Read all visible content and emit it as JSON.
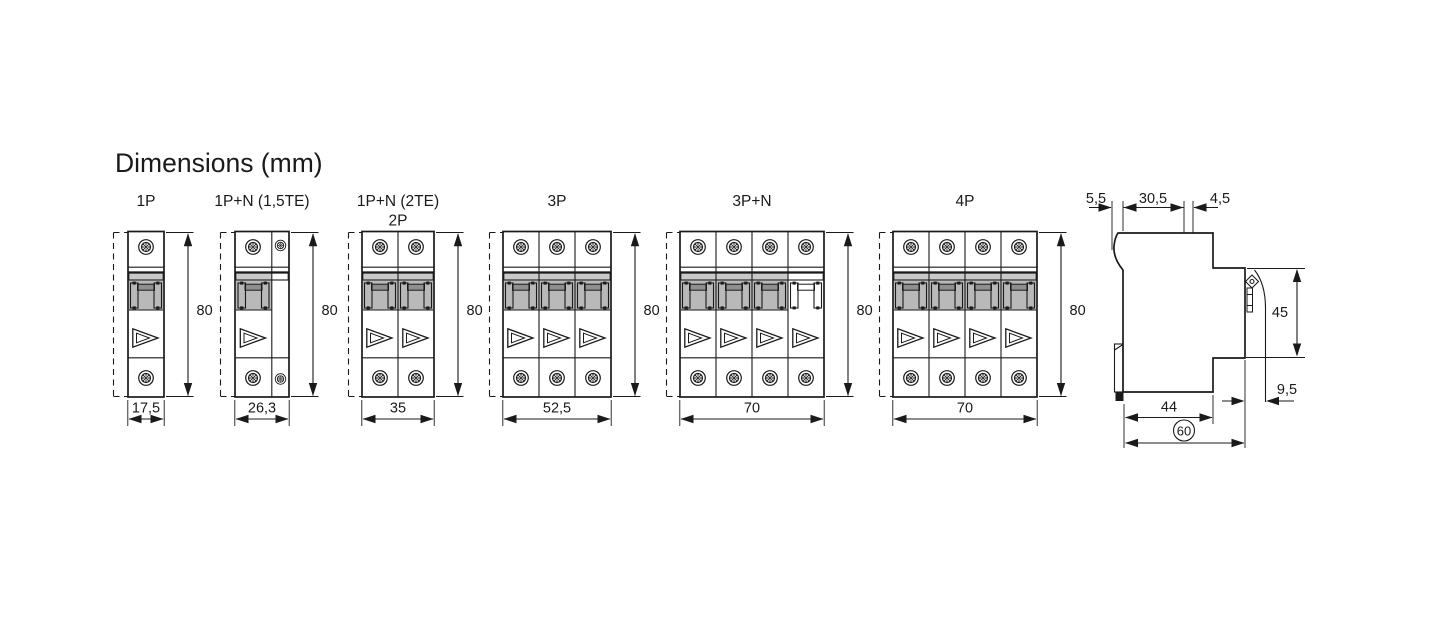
{
  "title": "Dimensions (mm)",
  "breakers": [
    {
      "label": "1P",
      "height_mm": "80",
      "width_mm": "17,5"
    },
    {
      "label": "1P+N (1,5TE)",
      "height_mm": "80",
      "width_mm": "26,3"
    },
    {
      "label": "1P+N (2TE)",
      "label_line2": "2P",
      "height_mm": "80",
      "width_mm": "35"
    },
    {
      "label": "3P",
      "height_mm": "80",
      "width_mm": "52,5"
    },
    {
      "label": "3P+N",
      "height_mm": "80",
      "width_mm": "70"
    },
    {
      "label": "4P",
      "height_mm": "80",
      "width_mm": "70"
    }
  ],
  "side_view": {
    "rear_hook_depth": "5,5",
    "rear_to_handle": "30,5",
    "handle_width": "4,5",
    "front_height": "45",
    "terminal_depth": "9,5",
    "base_depth": "44",
    "total_depth": "60"
  },
  "colors": {
    "line": "#1a1a1a",
    "band_gray": "#c9c9c9",
    "recess_gray": "#b9b9b9",
    "triangle_fill": "#c2c2c2",
    "toggle_bar_gray": "#8f8f8f",
    "background": "#ffffff"
  }
}
